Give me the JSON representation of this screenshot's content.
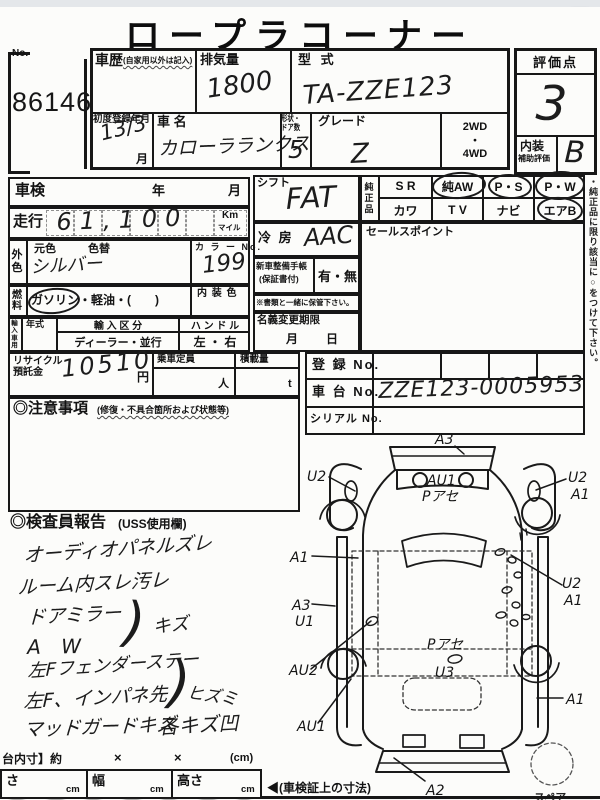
{
  "title": "ロープラコーナー",
  "no_box": {
    "label": "No.",
    "value": "86146"
  },
  "header": {
    "history_label": "車歴",
    "history_sub": "(自家用以外は記入)",
    "displacement_label": "排気量",
    "displacement_value": "1800",
    "model_label": "型 式",
    "model_value": "TA-ZZE123",
    "score_label": "評価点",
    "score_value": "3",
    "interior_label": "内装",
    "interior_sub": "補助評価",
    "interior_value": "B",
    "first_reg_label": "初度登録年月",
    "first_reg_value": "13/3",
    "first_reg_unit": "月",
    "name_label": "車 名",
    "name_value": "カローラランクス",
    "shape_label_1": "形状・",
    "shape_label_2": "ドア数",
    "shape_value": "5",
    "grade_label": "グレード",
    "grade_value": "Z",
    "drive_1": "2WD",
    "drive_dot": "・",
    "drive_2": "4WD"
  },
  "left": {
    "shaken_label": "車検",
    "year_label": "年",
    "month_label": "月",
    "mileage_label": "走行",
    "mileage_value": "61,100",
    "mileage_unit_km": "Km",
    "mileage_unit_mile": "マイル",
    "color_label": "外色",
    "base_color_label": "元色",
    "repaint_label": "色替",
    "color_value": "シルバー",
    "color_no_label": "カ ラ ー No.",
    "color_no_value": "199",
    "fuel_label": "燃料",
    "fuel_value": "ガソリン・軽油・(　　)",
    "interior_color_label": "内 装 色",
    "import_label": "輸入車用",
    "model_year_label": "年式",
    "import_class_label": "輸 入 区 分",
    "import_class_value": "ディーラー・並行",
    "handle_label": "ハ ン ド ル",
    "handle_value": "左 ・ 右",
    "recycle_label_1": "リサイクル",
    "recycle_label_2": "預託金",
    "recycle_value": "10510",
    "recycle_unit": "円",
    "capacity_label": "乗車定員",
    "capacity_unit": "人",
    "load_label": "積載量",
    "load_unit": "t",
    "caution_label": "◎注意事項",
    "caution_sub": "(修復・不具合箇所および状態等)"
  },
  "middle": {
    "shift_label": "シフト",
    "shift_value": "FAT",
    "ac_label": "冷 房",
    "ac_value": "AAC",
    "notebook_label": "新車整備手帳",
    "notebook_sub": "(保証書付)",
    "notebook_value": "有・無",
    "keep_note": "※書類と一緒に保管下さい。",
    "transfer_label": "名義変更期限",
    "transfer_month": "月",
    "transfer_day": "日"
  },
  "right": {
    "genuine_label": "純正品",
    "options_row1": [
      "S R",
      "純AW",
      "P・S",
      "P・W"
    ],
    "options_row2": [
      "カワ",
      "T V",
      "ナビ",
      "エアB"
    ],
    "circled_options": [
      "純AW",
      "P・S",
      "P・W",
      "エアB"
    ],
    "sales_label": "セールスポイント",
    "reg_label": "登 録 No.",
    "chassis_label": "車 台 No.",
    "chassis_value": "ZZE123-0005953",
    "serial_label": "シリアル No.",
    "side_note": "・純正品に限り該当に○をつけて下さい。"
  },
  "report": {
    "heading": "◎検査員報告",
    "heading_sub": "(USS使用欄)",
    "note_1": "オーディオパネルズレ",
    "note_2": "ルーム内スレ汚レ",
    "note_3": "ドアミラー",
    "note_4": "A W",
    "bracket": ")",
    "note_34_result": "キズ",
    "note_5": "左Fフェンダーステー",
    "note_6": "左F、インパネ先",
    "note_56_result": "ヒズミ",
    "note_7": "マッドガードキズ",
    "note_8": "各キズ凹"
  },
  "diagram": {
    "front": "A3",
    "left_front_fender": "U2",
    "hood_1": "AU1",
    "hood_2": "Pアセ",
    "right_front_fender_1": "U2",
    "right_front_fender_2": "A1",
    "left_door": "A1",
    "left_sill_1": "A3",
    "left_sill_2": "U1",
    "left_rear_fender": "AU2",
    "left_rear": "AU1",
    "roof_1": "Pアセ",
    "roof_2": "U3",
    "right_door_1": "U2",
    "right_door_2": "A1",
    "right_rear_fender": "A1",
    "rear": "A2",
    "spare": "スペア"
  },
  "footer": {
    "cargo_dim_label": "台内寸】約",
    "times_1": "×",
    "times_2": "×",
    "unit_paren": "(cm)",
    "length_label": "さ",
    "width_label": "幅",
    "height_label": "高さ",
    "cm": "cm",
    "reg_dim_note": "◀(車検証上の寸法)"
  }
}
